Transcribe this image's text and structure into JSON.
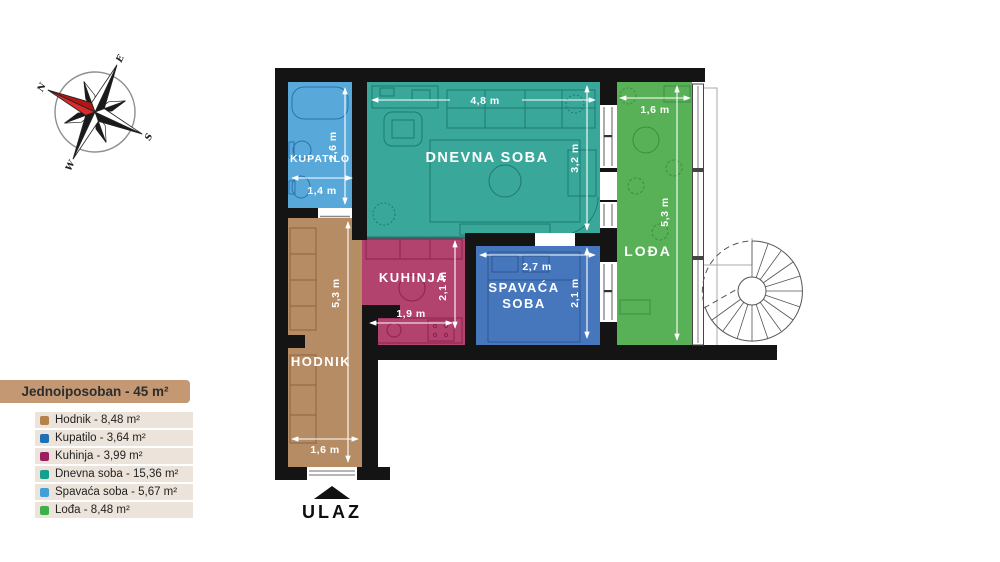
{
  "compass": {
    "n": "N",
    "e": "E",
    "s": "S",
    "w": "W"
  },
  "legend": {
    "title": "Jednoiposoban - 45 m²",
    "title_bg": "#c39873",
    "items": [
      {
        "label": "Hodnik - 8,48 m²",
        "color": "#b5824c"
      },
      {
        "label": "Kupatilo - 3,64 m²",
        "color": "#2070b8"
      },
      {
        "label": "Kuhinja - 3,99 m²",
        "color": "#9e1f5f"
      },
      {
        "label": "Dnevna soba - 15,36 m²",
        "color": "#14a08e"
      },
      {
        "label": "Spavaća soba - 5,67 m²",
        "color": "#3fa0d8"
      },
      {
        "label": "Lođa - 8,48 m²",
        "color": "#3eb04b"
      }
    ]
  },
  "plan": {
    "entrance_label": "ULAZ",
    "rooms": {
      "kupatilo": {
        "label": "KUPATILO",
        "color": "#58a9da",
        "width": "1,4 m",
        "height": "2,6 m"
      },
      "dnevna": {
        "label": "DNEVNA SOBA",
        "color": "#39a89a",
        "width": "4,8 m",
        "height": "3,2 m"
      },
      "lodja": {
        "label": "LOĐA",
        "color": "#58b157",
        "width": "1,6 m",
        "height": "5,3 m"
      },
      "kuhinja": {
        "label": "KUHINJA",
        "color": "#b2426e",
        "width": "1,9 m",
        "height": "2,1 m"
      },
      "spavaca": {
        "label_line1": "SPAVAĆA",
        "label_line2": "SOBA",
        "color": "#4677bd",
        "width": "2,7 m",
        "height": "2,1 m"
      },
      "hodnik": {
        "label": "HODNIK",
        "color": "#b68c64",
        "width": "1,6 m",
        "height": "5,3 m"
      }
    }
  }
}
